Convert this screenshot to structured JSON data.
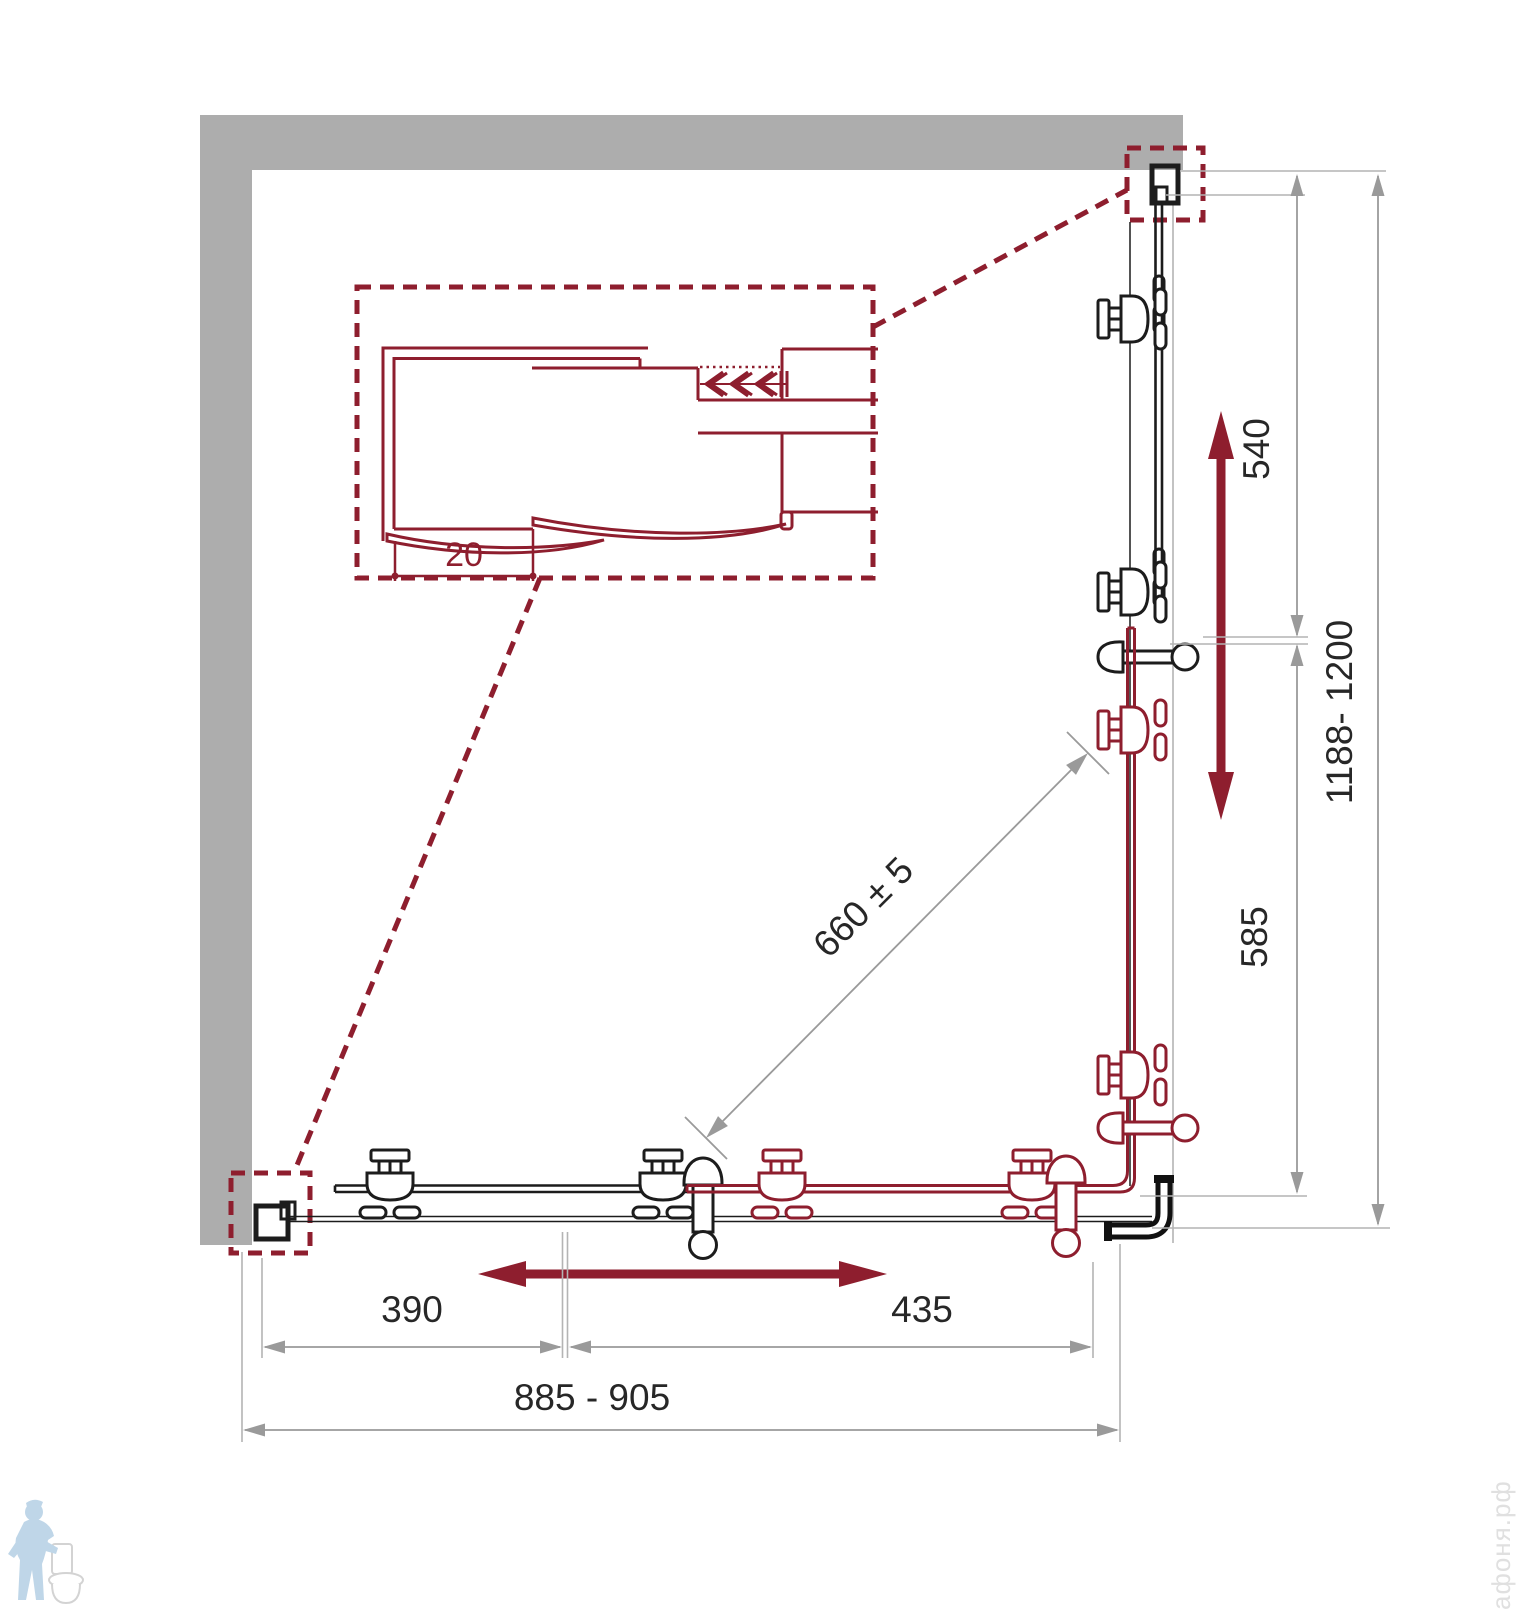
{
  "page": {
    "background": "#ffffff"
  },
  "diagram": {
    "type": "technical-drawing",
    "subject": "corner shower enclosure plan view with two sliding doors, wall detail callout and dimensions (mm)",
    "labels": {
      "detail_profile_width": "20",
      "right_door_travel": "540",
      "right_depth_range": "1188- 1200",
      "right_fixed_panel": "585",
      "diagonal_entry": "660 ± 5",
      "bottom_door_travel": "390",
      "bottom_fixed_panel": "435",
      "bottom_width_range": "885 - 905"
    },
    "colors": {
      "page-bg": "#ffffff",
      "accent-red": "#8e1e2e",
      "wall-gray": "#adadad",
      "dim-gray": "#9a9a9a",
      "line-black": "#1c1c1c",
      "watermark-blue": "#b9d2e6",
      "watermark-gray": "#e0e0e0"
    },
    "watermark": {
      "site": "афоня.рф"
    }
  }
}
